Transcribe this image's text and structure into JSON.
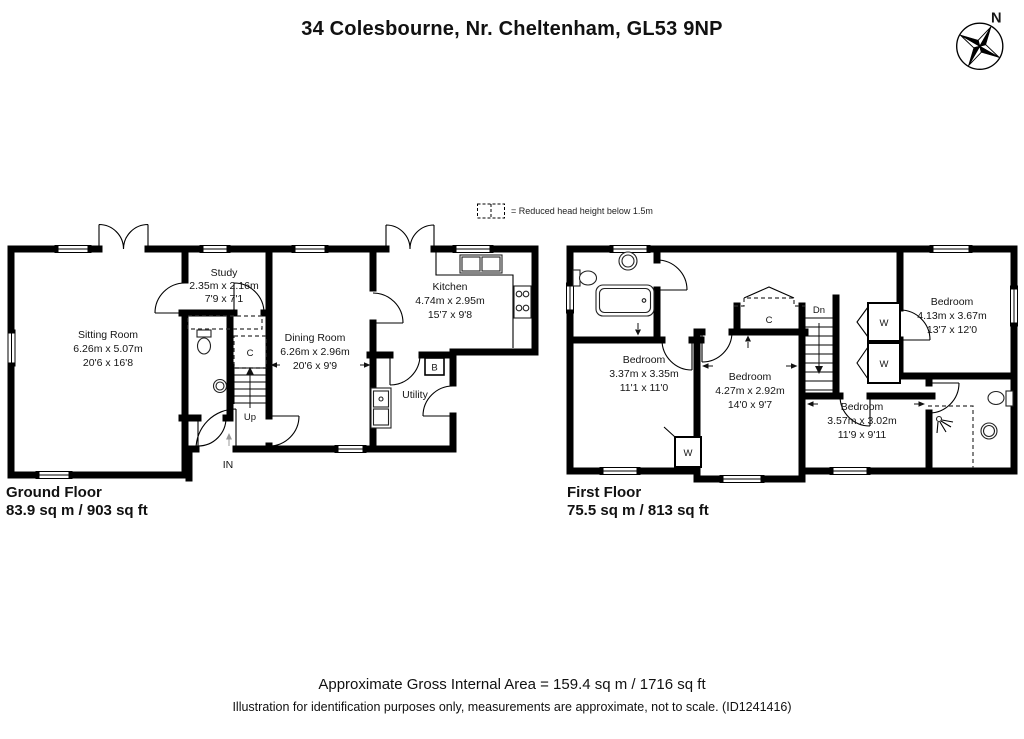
{
  "title": "34 Colesbourne, Nr. Cheltenham, GL53 9NP",
  "compass_n": "N",
  "legend_text": "= Reduced head height below 1.5m",
  "gf": {
    "floor_label": "Ground Floor",
    "floor_area": "83.9 sq m / 903 sq ft",
    "sitting": {
      "name": "Sitting Room",
      "m": "6.26m x 5.07m",
      "i": "20'6 x 16'8"
    },
    "study": {
      "name": "Study",
      "m": "2.35m x 2.16m",
      "i": "7'9 x 7'1"
    },
    "dining": {
      "name": "Dining Room",
      "m": "6.26m x 2.96m",
      "i": "20'6 x 9'9"
    },
    "kitchen": {
      "name": "Kitchen",
      "m": "4.74m x 2.95m",
      "i": "15'7 x 9'8"
    },
    "utility": "Utility",
    "up": "Up",
    "in_label": "IN",
    "c": "C",
    "b": "B"
  },
  "ff": {
    "floor_label": "First Floor",
    "floor_area": "75.5 sq m / 813 sq ft",
    "bed1": {
      "name": "Bedroom",
      "m": "3.37m x 3.35m",
      "i": "11'1 x 11'0"
    },
    "bed2": {
      "name": "Bedroom",
      "m": "4.27m x 2.92m",
      "i": "14'0 x 9'7"
    },
    "bed3": {
      "name": "Bedroom",
      "m": "3.57m x 3.02m",
      "i": "11'9 x 9'11"
    },
    "bed4": {
      "name": "Bedroom",
      "m": "4.13m x 3.67m",
      "i": "13'7 x 12'0"
    },
    "dn": "Dn",
    "c": "C",
    "w": "W"
  },
  "footer": {
    "gross_area": "Approximate Gross Internal Area = 159.4 sq m / 1716 sq ft",
    "disclaimer": "Illustration for identification purposes only, measurements are approximate, not to scale. (ID1241416)"
  }
}
